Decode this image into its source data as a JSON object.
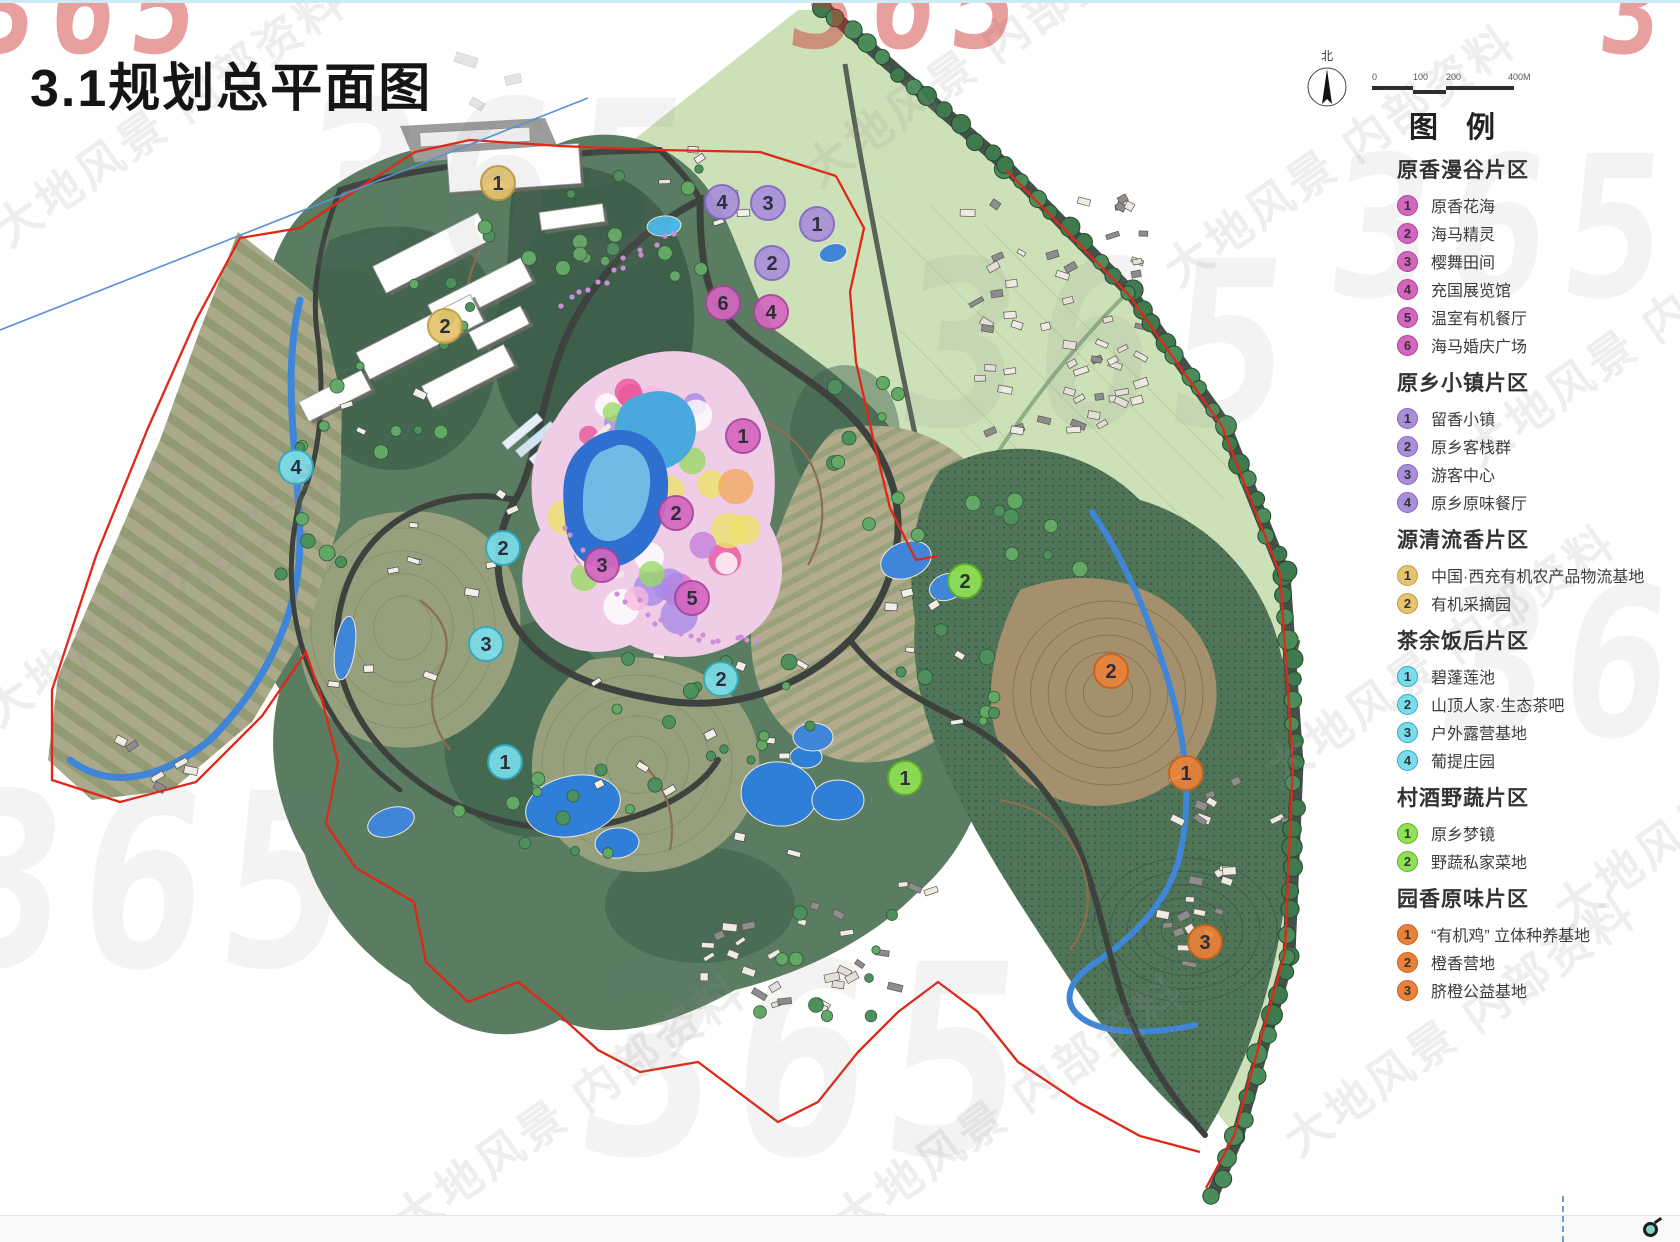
{
  "page": {
    "title": "3.1规划总平面图"
  },
  "map": {
    "north_label": "北",
    "scale_labels": [
      "0",
      "100",
      "200",
      "400M"
    ],
    "watermark_text": "大地风景 内部资料",
    "watermark_logo": "365",
    "markers": [
      {
        "section": 0,
        "n": "1",
        "x": 743,
        "y": 436
      },
      {
        "section": 0,
        "n": "2",
        "x": 676,
        "y": 513
      },
      {
        "section": 0,
        "n": "3",
        "x": 602,
        "y": 565
      },
      {
        "section": 0,
        "n": "4",
        "x": 771,
        "y": 312
      },
      {
        "section": 0,
        "n": "5",
        "x": 692,
        "y": 598
      },
      {
        "section": 0,
        "n": "6",
        "x": 723,
        "y": 303
      },
      {
        "section": 1,
        "n": "1",
        "x": 817,
        "y": 224
      },
      {
        "section": 1,
        "n": "2",
        "x": 772,
        "y": 263
      },
      {
        "section": 1,
        "n": "3",
        "x": 768,
        "y": 203
      },
      {
        "section": 1,
        "n": "4",
        "x": 722,
        "y": 202
      },
      {
        "section": 2,
        "n": "1",
        "x": 498,
        "y": 183
      },
      {
        "section": 2,
        "n": "2",
        "x": 445,
        "y": 326
      },
      {
        "section": 3,
        "n": "1",
        "x": 505,
        "y": 762
      },
      {
        "section": 3,
        "n": "2",
        "x": 503,
        "y": 548
      },
      {
        "section": 3,
        "n": "2",
        "x": 721,
        "y": 679
      },
      {
        "section": 3,
        "n": "3",
        "x": 486,
        "y": 644
      },
      {
        "section": 3,
        "n": "4",
        "x": 296,
        "y": 467
      },
      {
        "section": 4,
        "n": "1",
        "x": 905,
        "y": 778
      },
      {
        "section": 4,
        "n": "2",
        "x": 965,
        "y": 581
      },
      {
        "section": 5,
        "n": "1",
        "x": 1186,
        "y": 773
      },
      {
        "section": 5,
        "n": "2",
        "x": 1111,
        "y": 671
      },
      {
        "section": 5,
        "n": "3",
        "x": 1205,
        "y": 942
      }
    ]
  },
  "legend": {
    "title": "图 例",
    "sections": [
      {
        "title": "原香漫谷片区",
        "color": "#d466c0",
        "border": "#a8439a",
        "items": [
          {
            "n": "1",
            "label": "原香花海"
          },
          {
            "n": "2",
            "label": "海马精灵"
          },
          {
            "n": "3",
            "label": "樱舞田间"
          },
          {
            "n": "4",
            "label": "充国展览馆"
          },
          {
            "n": "5",
            "label": "温室有机餐厅"
          },
          {
            "n": "6",
            "label": "海马婚庆广场"
          }
        ]
      },
      {
        "title": "原乡小镇片区",
        "color": "#a98fd9",
        "border": "#8265c2",
        "items": [
          {
            "n": "1",
            "label": "留香小镇"
          },
          {
            "n": "2",
            "label": "原乡客栈群"
          },
          {
            "n": "3",
            "label": "游客中心"
          },
          {
            "n": "4",
            "label": "原乡原味餐厅"
          }
        ]
      },
      {
        "title": "源清流香片区",
        "color": "#e5c46d",
        "border": "#c09a3e",
        "items": [
          {
            "n": "1",
            "label": "中国·西充有机农产品物流基地"
          },
          {
            "n": "2",
            "label": "有机采摘园"
          }
        ]
      },
      {
        "title": "茶余饭后片区",
        "color": "#7addea",
        "border": "#2fa9c2",
        "items": [
          {
            "n": "1",
            "label": "碧蓬莲池"
          },
          {
            "n": "2",
            "label": "山顶人家·生态茶吧"
          },
          {
            "n": "3",
            "label": "户外露营基地"
          },
          {
            "n": "4",
            "label": "葡提庄园"
          }
        ]
      },
      {
        "title": "村酒野蔬片区",
        "color": "#90e153",
        "border": "#5fb027",
        "items": [
          {
            "n": "1",
            "label": "原乡梦镜"
          },
          {
            "n": "2",
            "label": "野蔬私家菜地"
          }
        ]
      },
      {
        "title": "园香原味片区",
        "color": "#e98238",
        "border": "#c7611c",
        "items": [
          {
            "n": "1",
            "label": "“有机鸡” 立体种养基地"
          },
          {
            "n": "2",
            "label": "橙香营地"
          },
          {
            "n": "3",
            "label": "脐橙公益基地"
          }
        ]
      }
    ]
  }
}
